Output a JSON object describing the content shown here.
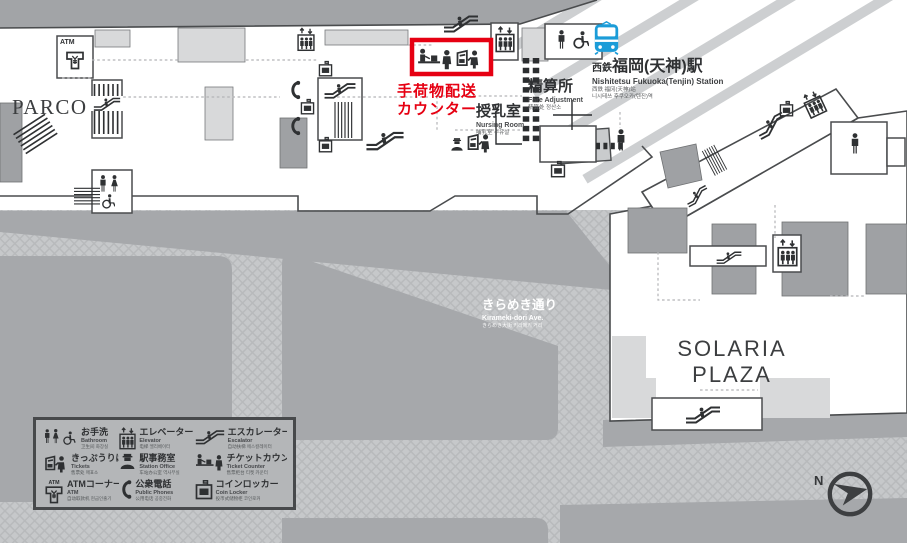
{
  "title": "Nishitetsu Fukuoka (Tenjin) Station area floor map",
  "colors": {
    "accent_red": "#e60012",
    "train_blue": "#1b9cd8",
    "outline": "#4a4c4e",
    "outside_gray": "#a2a4a7",
    "road_gray": "#c6c8ca",
    "room_light": "#d8d9da",
    "room_mid": "#9fa1a4",
    "floor_white": "#ffffff"
  },
  "highlight": {
    "line1": "手荷物配送",
    "line2": "カウンター"
  },
  "landmarks": {
    "parco": "PARCO",
    "solaria_line1": "SOLARIA",
    "solaria_line2": "PLAZA"
  },
  "station": {
    "prefix": "西鉄",
    "name": "福岡(天神)駅",
    "en": "Nishitetsu Fukuoka(Tenjin) Station",
    "zh": "西鉄 福冈(天神)站",
    "ko": "니시테쓰 후쿠오카(텐진)역"
  },
  "facilities": {
    "nursing": {
      "ja": "授乳室",
      "en": "Nursing Room",
      "sub": "哺乳室 수유실"
    },
    "fare": {
      "ja": "精算所",
      "en": "Fare Adjustment",
      "sub": "精算处 정산소"
    },
    "atm_label": "ATM"
  },
  "street": {
    "ja": "きらめき通り",
    "en": "Kirameki-dori Ave.",
    "sub": "きらめき大街 키라메키 거리"
  },
  "compass": {
    "label": "N"
  },
  "legend": {
    "items": [
      {
        "id": "restroom",
        "ja": "お手洗",
        "en": "Bathroom",
        "sub": "卫生间 화장실",
        "icon": "restroom-icon"
      },
      {
        "id": "elevator",
        "ja": "エレベーター",
        "en": "Elevator",
        "sub": "电梯 엘리베이터",
        "icon": "elevator-icon"
      },
      {
        "id": "escalator",
        "ja": "エスカレーター",
        "en": "Escalator",
        "sub": "自动扶梯 에스컬레이터",
        "icon": "escalator-icon"
      },
      {
        "id": "tickets",
        "ja": "きっぷうりば",
        "en": "Tickets",
        "sub": "售票处 매표소",
        "icon": "ticket-machine-icon"
      },
      {
        "id": "station-office",
        "ja": "駅事務室",
        "en": "Station Office",
        "sub": "车站办公室 역사무실",
        "icon": "station-staff-icon"
      },
      {
        "id": "ticket-counter",
        "ja": "チケットカウンター",
        "en": "Ticket Counter",
        "sub": "售票柜台 티켓 카운터",
        "icon": "ticket-counter-icon"
      },
      {
        "id": "atm",
        "ja": "ATMコーナー",
        "en": "ATM",
        "sub": "自动取款机 현금인출기",
        "icon": "atm-icon"
      },
      {
        "id": "public-phone",
        "ja": "公衆電話",
        "en": "Public Phones",
        "sub": "公用电话 공중전화",
        "icon": "phone-icon"
      },
      {
        "id": "coin-locker",
        "ja": "コインロッカー",
        "en": "Coin Locker",
        "sub": "投币式储物柜 코인로커",
        "icon": "coin-locker-icon"
      }
    ]
  },
  "map_icons": [
    "train-icon",
    "escalator-icon",
    "elevator-icon",
    "stairs-icon",
    "restroom-icon",
    "wheelchair-icon",
    "phone-icon",
    "coin-locker-icon",
    "ticket-machine-icon",
    "station-staff-icon",
    "ticket-counter-icon",
    "atm-icon",
    "compass-icon"
  ]
}
